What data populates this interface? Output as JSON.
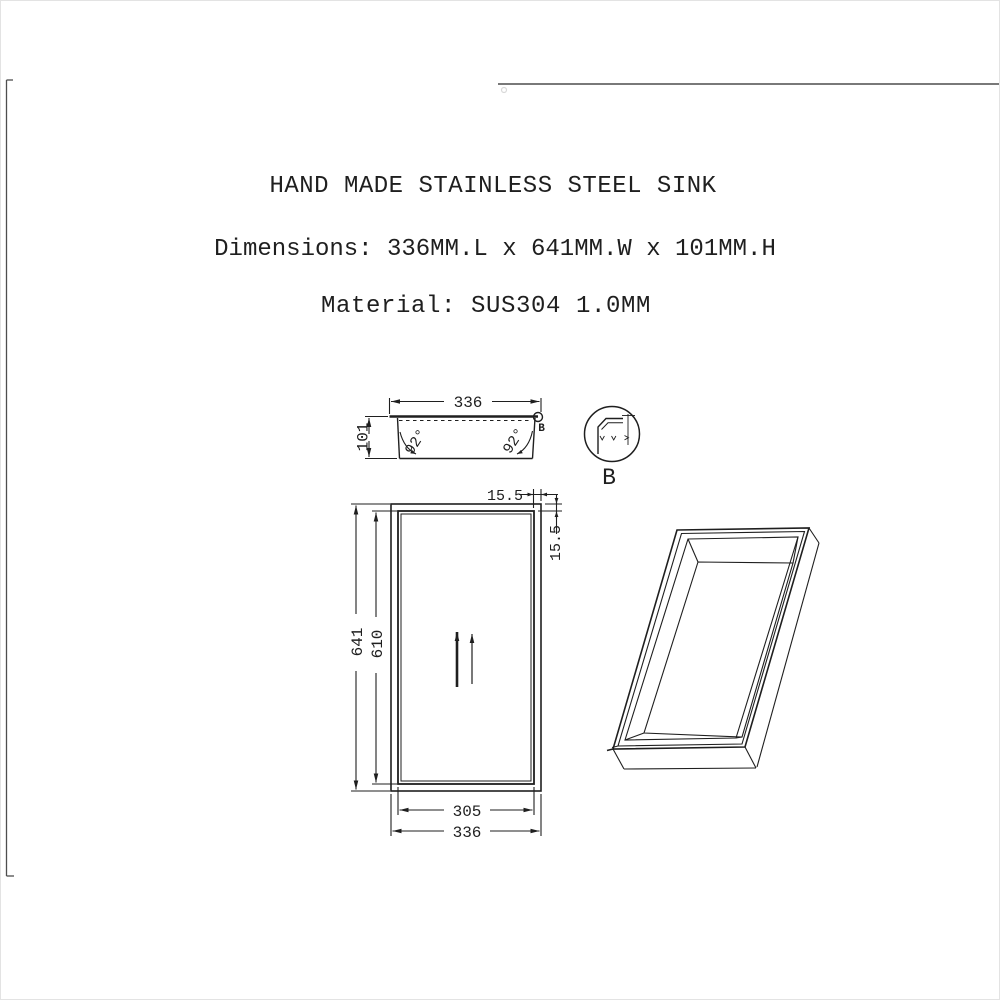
{
  "header": {
    "title": "HAND MADE STAINLESS STEEL SINK",
    "dimensions_line": "Dimensions: 336MM.L x 641MM.W x 101MM.H",
    "material_line": "Material: SUS304 1.0MM"
  },
  "section_view": {
    "width_label": "336",
    "height_label": "101",
    "angle_left_label": "92°",
    "angle_right_label": "92°",
    "detail_marker_label": "B"
  },
  "detail_view": {
    "label": "B"
  },
  "plan_view": {
    "outer_length_label": "641",
    "inner_length_label": "610",
    "rim_top_label": "15.5",
    "rim_right_label": "15.5",
    "inner_width_label": "305",
    "outer_width_label": "336"
  },
  "colors": {
    "line": "#1f1f1f",
    "sheet_edge": "#4d4d4d",
    "background": "#ffffff"
  }
}
